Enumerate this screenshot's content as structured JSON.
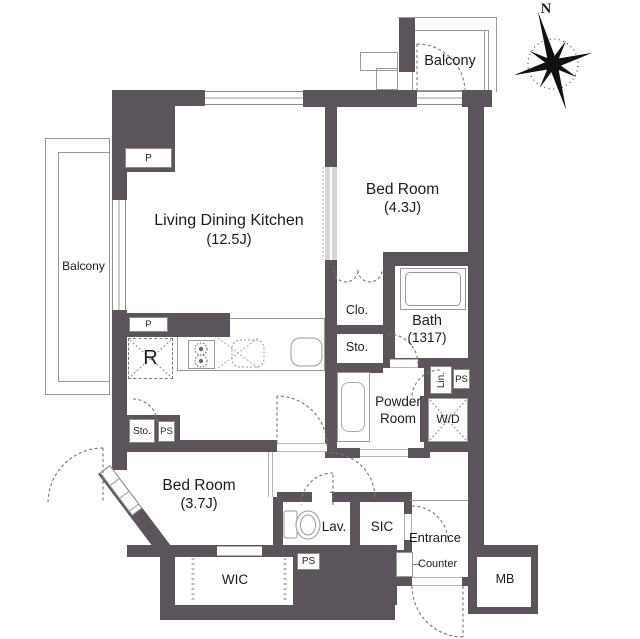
{
  "colors": {
    "wall": "#5b555b",
    "line": "#999999",
    "dash": "#777777"
  },
  "compass": {
    "north": "N"
  },
  "rooms": {
    "balcony_top": "Balcony",
    "balcony_left": "Balcony",
    "ldk": {
      "name": "Living Dining Kitchen",
      "size": "(12.5J)"
    },
    "bedroom_east": {
      "name": "Bed Room",
      "size": "(4.3J)"
    },
    "bedroom_south": {
      "name": "Bed Room",
      "size": "(3.7J)"
    },
    "bath": {
      "name": "Bath",
      "size": "(1317)"
    },
    "powder_room": {
      "line1": "Powder",
      "line2": "Room"
    },
    "wic": "WIC",
    "sic": "SIC",
    "lav": "Lav.",
    "entrance": "Entrance",
    "counter": "Counter",
    "mb": "MB"
  },
  "fixtures": {
    "closet": "Clo.",
    "storage_closet": "Sto.",
    "storage_ldk": "Sto.",
    "linen": "Lin.",
    "washer_dryer": "W/D",
    "refrigerator": "R",
    "pipe_space_top": "P",
    "pipe_space_kitchen": "P",
    "ps_bath": "PS",
    "ps_ldk": "PS",
    "ps_wic": "PS"
  }
}
